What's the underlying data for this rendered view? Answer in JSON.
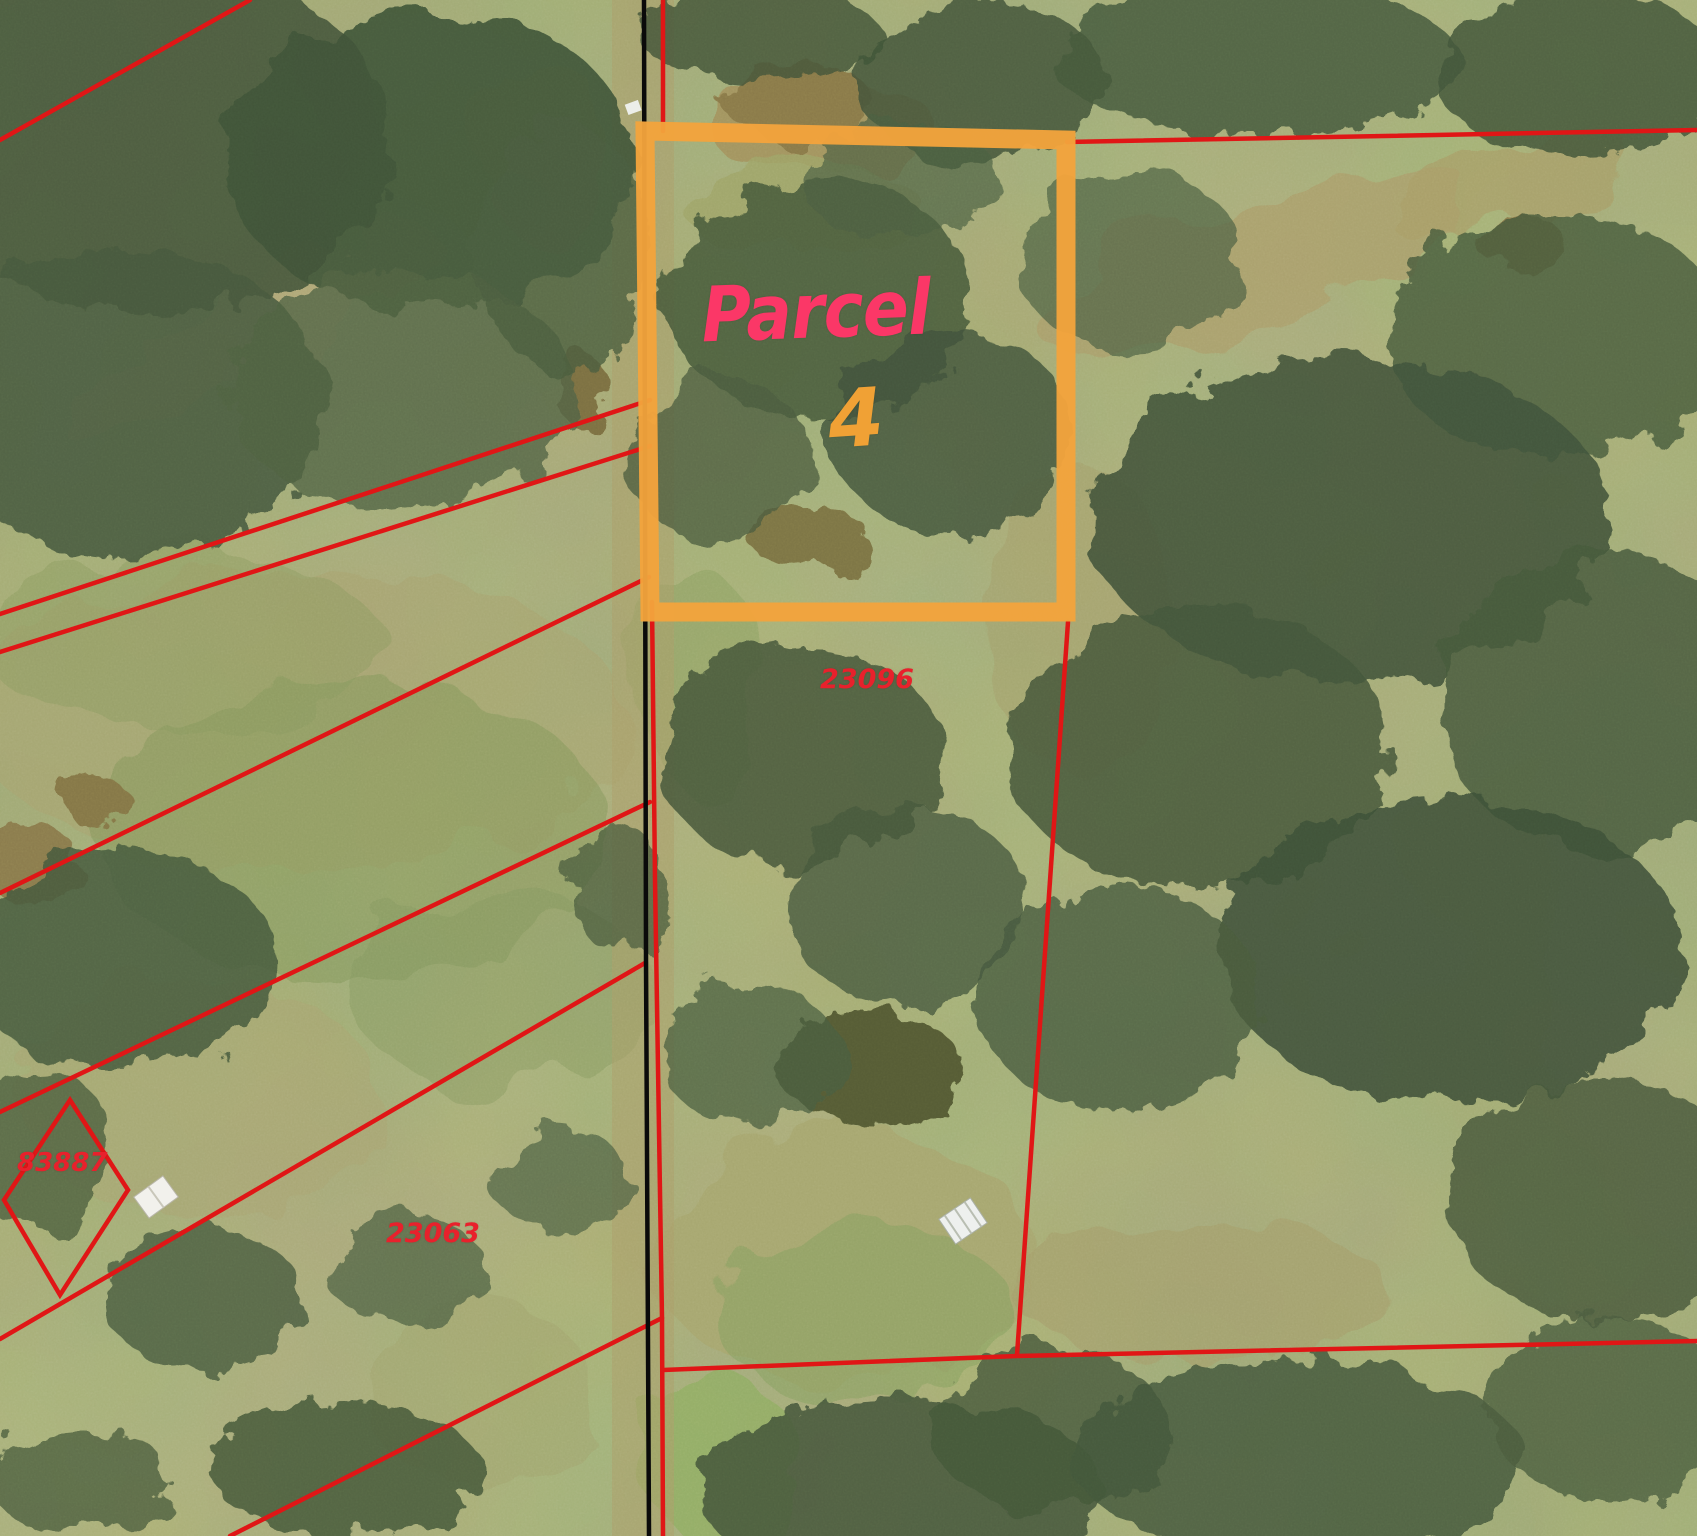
{
  "map": {
    "type": "aerial-parcel-map",
    "highlight": {
      "label": "Parcel",
      "number": "4",
      "label_color": "#fb3767",
      "number_color": "#f0a135",
      "outline_color": "#f2a33c"
    },
    "parcels": [
      {
        "id": "23096",
        "label_color": "#e8212c"
      },
      {
        "id": "83887",
        "label_color": "#e8212c"
      },
      {
        "id": "23063",
        "label_color": "#e8212c"
      }
    ],
    "colors": {
      "boundary_line": "#e01616",
      "road_line": "#000000",
      "terrain_base": "#97a06b"
    }
  }
}
